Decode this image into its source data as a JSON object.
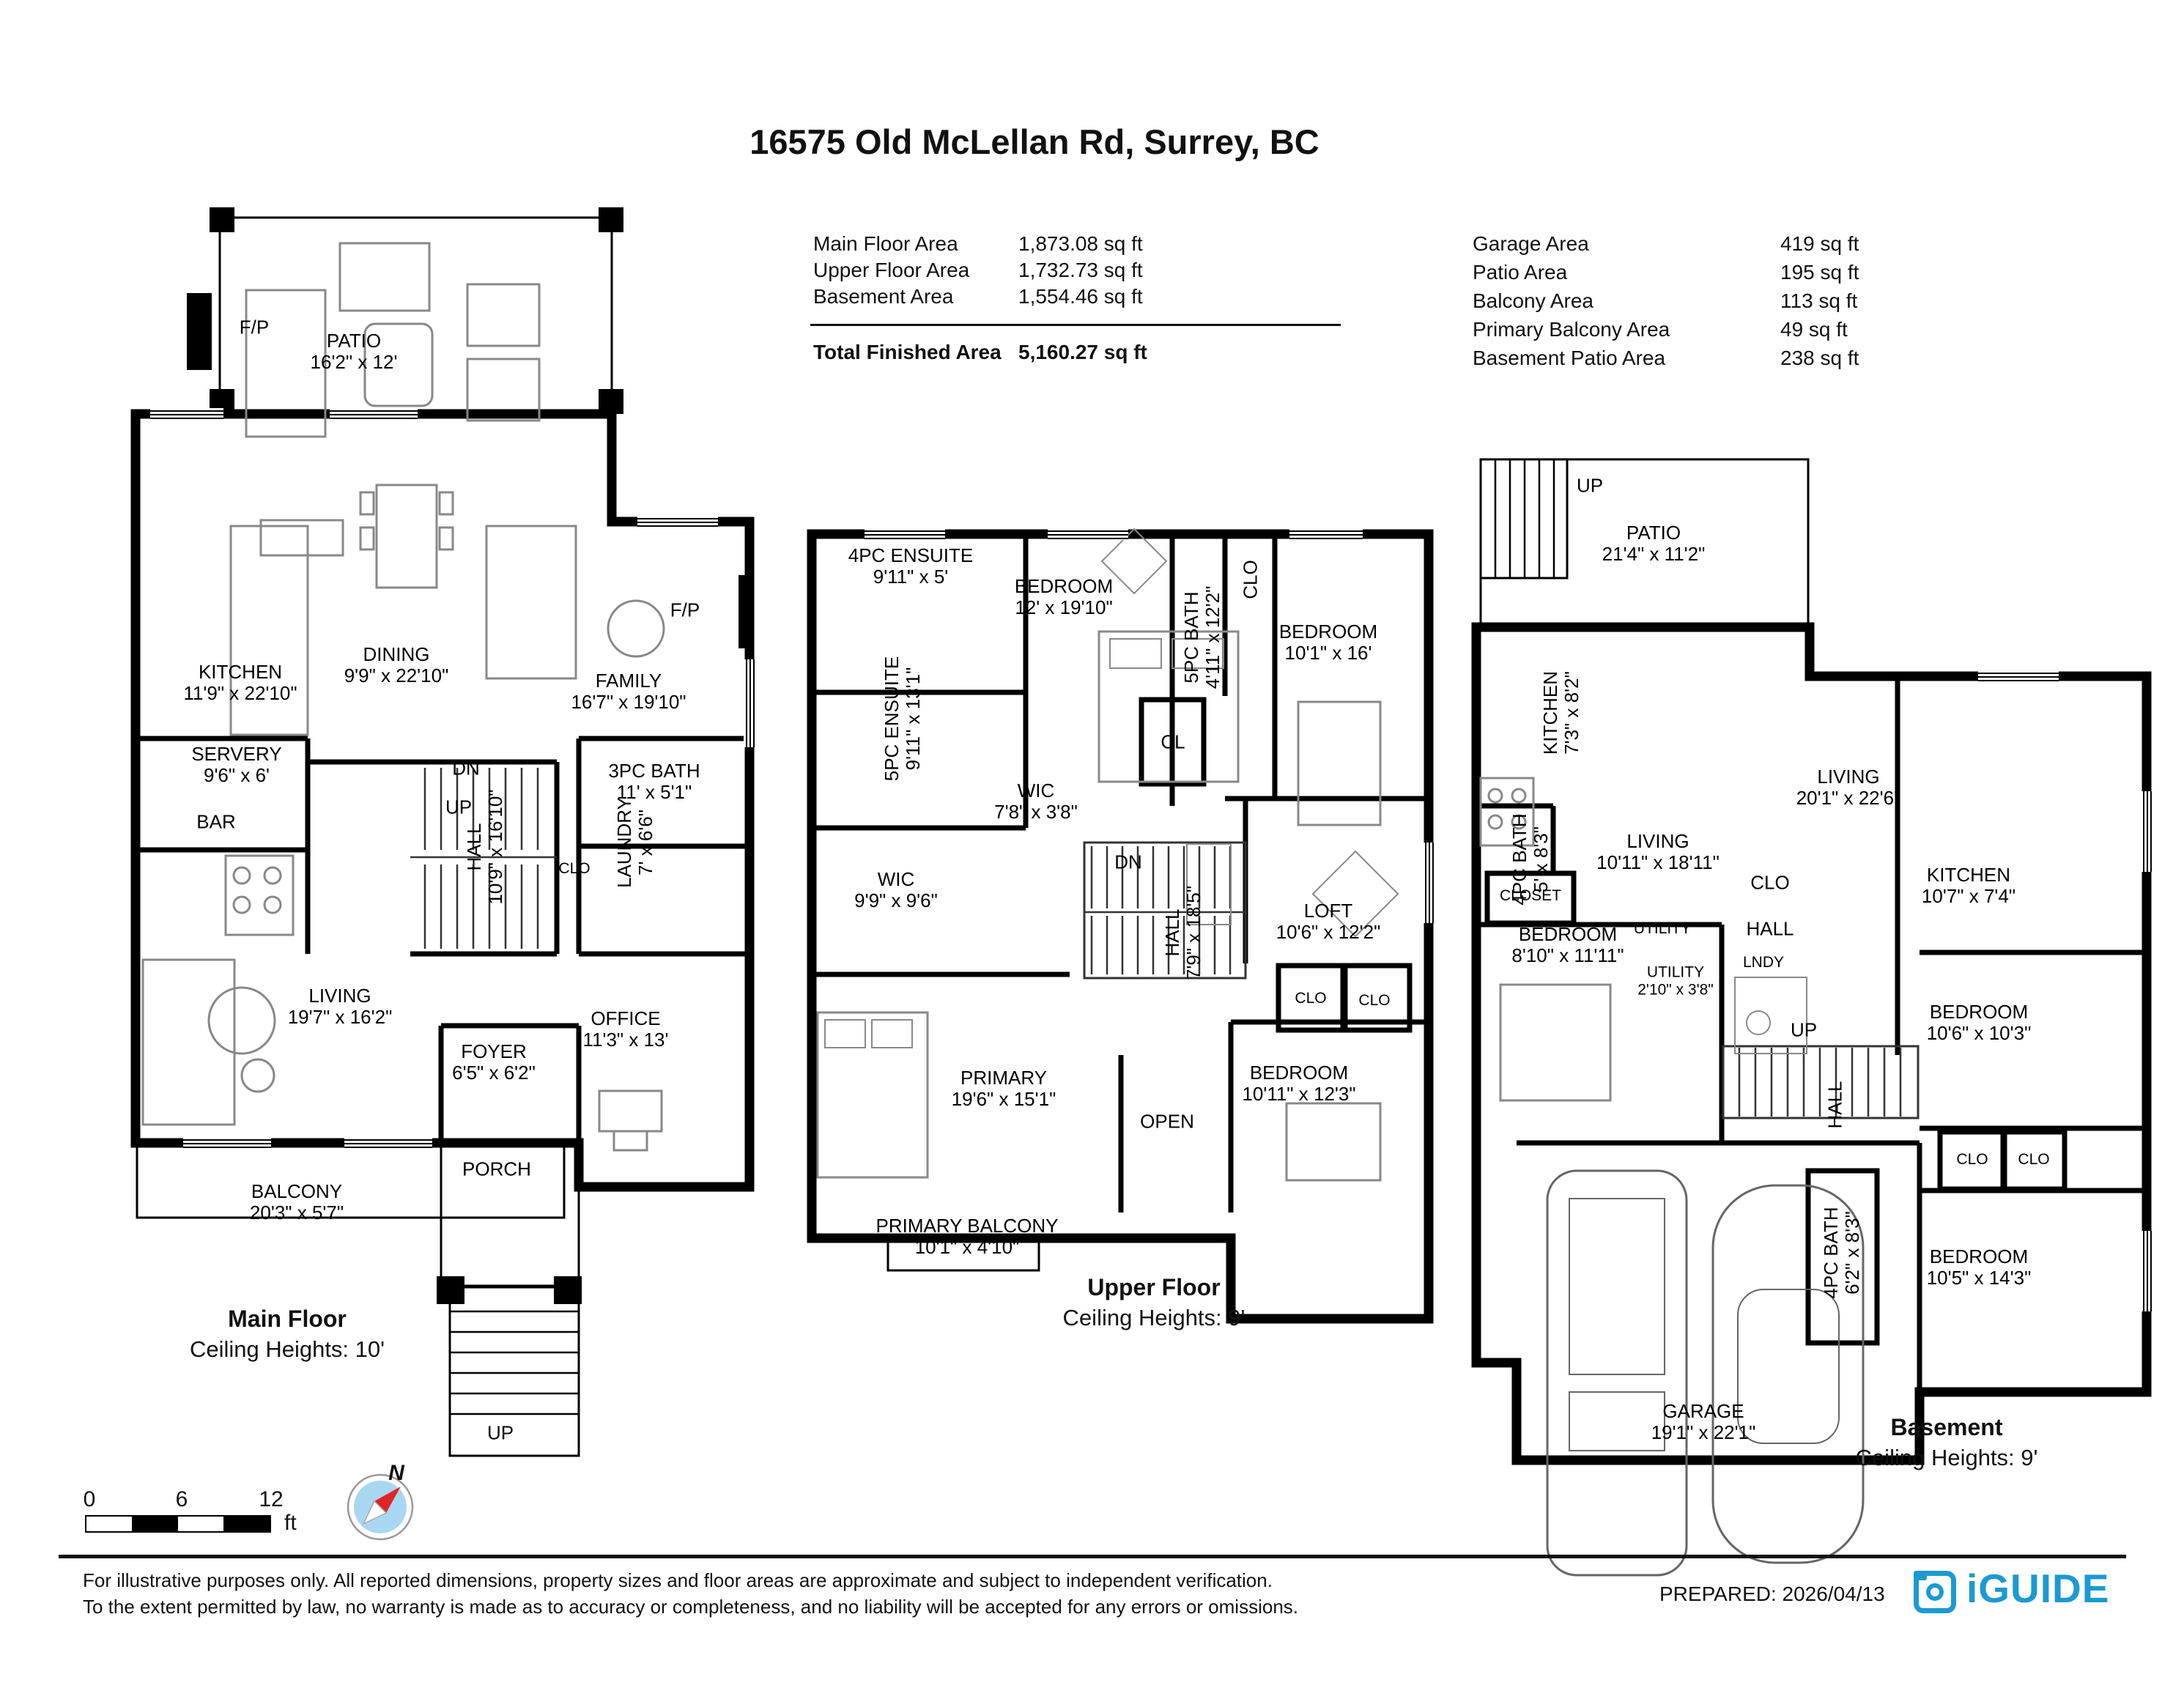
{
  "title": "16575 Old McLellan Rd, Surrey, BC",
  "summary": {
    "left": [
      {
        "label": "Main Floor Area",
        "value": "1,873.08 sq ft"
      },
      {
        "label": "Upper Floor Area",
        "value": "1,732.73 sq ft"
      },
      {
        "label": "Basement Area",
        "value": "1,554.46 sq ft"
      }
    ],
    "total": {
      "label": "Total Finished Area",
      "value": "5,160.27 sq ft"
    },
    "right": [
      {
        "label": "Garage Area",
        "value": "419 sq ft"
      },
      {
        "label": "Patio Area",
        "value": "195 sq ft"
      },
      {
        "label": "Balcony Area",
        "value": "113 sq ft"
      },
      {
        "label": "Primary Balcony Area",
        "value": "49 sq ft"
      },
      {
        "label": "Basement Patio Area",
        "value": "238 sq ft"
      }
    ]
  },
  "floors": [
    {
      "caption": "Main Floor",
      "ceiling": "Ceiling Heights: 10'",
      "rooms": [
        {
          "label": "F/P"
        },
        {
          "label": "PATIO",
          "dims": "16'2\" x 12'"
        },
        {
          "label": "KITCHEN",
          "dims": "11'9\" x 22'10\""
        },
        {
          "label": "DINING",
          "dims": "9'9\" x 22'10\""
        },
        {
          "label": "FAMILY",
          "dims": "16'7\" x 19'10\""
        },
        {
          "label": "F/P"
        },
        {
          "label": "SERVERY",
          "dims": "9'6\" x 6'"
        },
        {
          "label": "DN"
        },
        {
          "label": "3PC BATH",
          "dims": "11' x 5'1\""
        },
        {
          "label": "UP"
        },
        {
          "label": "BAR"
        },
        {
          "label": "HALL",
          "dims": "10'9\" x 16'10\""
        },
        {
          "label": "CLO"
        },
        {
          "label": "LAUNDRY",
          "dims": "7' x 6'6\""
        },
        {
          "label": "LIVING",
          "dims": "19'7\" x 16'2\""
        },
        {
          "label": "FOYER",
          "dims": "6'5\" x 6'2\""
        },
        {
          "label": "OFFICE",
          "dims": "11'3\" x 13'"
        },
        {
          "label": "PORCH"
        },
        {
          "label": "BALCONY",
          "dims": "20'3\" x 5'7\""
        },
        {
          "label": "UP"
        }
      ]
    },
    {
      "caption": "Upper Floor",
      "ceiling": "Ceiling Heights: 9'",
      "rooms": [
        {
          "label": "4PC ENSUITE",
          "dims": "9'11\" x 5'"
        },
        {
          "label": "BEDROOM",
          "dims": "12' x 19'10\""
        },
        {
          "label": "5PC BATH",
          "dims": "4'11\" x 12'2\""
        },
        {
          "label": "CLO"
        },
        {
          "label": "BEDROOM",
          "dims": "10'1\" x 16'"
        },
        {
          "label": "5PC ENSUITE",
          "dims": "9'11\" x 13'1\""
        },
        {
          "label": "WIC",
          "dims": "7'8\" x 3'8\""
        },
        {
          "label": "CL"
        },
        {
          "label": "DN"
        },
        {
          "label": "WIC",
          "dims": "9'9\" x 9'6\""
        },
        {
          "label": "HALL",
          "dims": "7'9\" x 18'5\""
        },
        {
          "label": "LOFT",
          "dims": "10'6\" x 12'2\""
        },
        {
          "label": "CLO"
        },
        {
          "label": "CLO"
        },
        {
          "label": "PRIMARY",
          "dims": "19'6\" x 15'1\""
        },
        {
          "label": "OPEN"
        },
        {
          "label": "BEDROOM",
          "dims": "10'11\" x 12'3\""
        },
        {
          "label": "PRIMARY BALCONY",
          "dims": "10'1\" x 4'10\""
        }
      ]
    },
    {
      "caption": "Basement",
      "ceiling": "Ceiling Heights: 9'",
      "rooms": [
        {
          "label": "UP"
        },
        {
          "label": "PATIO",
          "dims": "21'4\" x 11'2\""
        },
        {
          "label": "KITCHEN",
          "dims": "7'3\" x 8'2\""
        },
        {
          "label": "LIVING",
          "dims": "20'1\" x 22'6\""
        },
        {
          "label": "4PC BATH",
          "dims": "5' x 8'3\""
        },
        {
          "label": "LIVING",
          "dims": "10'11\" x 18'11\""
        },
        {
          "label": "CLO"
        },
        {
          "label": "KITCHEN",
          "dims": "10'7\" x 7'4\""
        },
        {
          "label": "CLOSET"
        },
        {
          "label": "BEDROOM",
          "dims": "8'10\" x 11'11\""
        },
        {
          "label": "UTILITY"
        },
        {
          "label": "HALL"
        },
        {
          "label": "UTILITY",
          "dims": "2'10\" x 3'8\""
        },
        {
          "label": "LNDY"
        },
        {
          "label": "UP"
        },
        {
          "label": "HALL"
        },
        {
          "label": "BEDROOM",
          "dims": "10'6\" x 10'3\""
        },
        {
          "label": "CLO"
        },
        {
          "label": "CLO"
        },
        {
          "label": "BEDROOM",
          "dims": "10'5\" x 14'3\""
        },
        {
          "label": "4PC BATH",
          "dims": "6'2\" x 8'3\""
        },
        {
          "label": "GARAGE",
          "dims": "19'1\" x 22'1\""
        }
      ]
    }
  ],
  "scalebar": {
    "ticks": [
      "0",
      "6",
      "12"
    ],
    "unit": "ft"
  },
  "compass": {
    "north": "N"
  },
  "footer": {
    "line1": "For illustrative purposes only. All reported dimensions, property sizes and floor areas are approximate and subject to independent verification.",
    "line2": "To the extent permitted by law, no warranty is made as to accuracy or completeness, and no liability will be accepted for any errors or omissions.",
    "prepared": "PREPARED: 2026/04/13",
    "brand": "iGUIDE"
  },
  "colors": {
    "brand_blue": "#1b9ad2",
    "compass_fill": "#a9d7f2",
    "compass_needle": "#e02525"
  }
}
